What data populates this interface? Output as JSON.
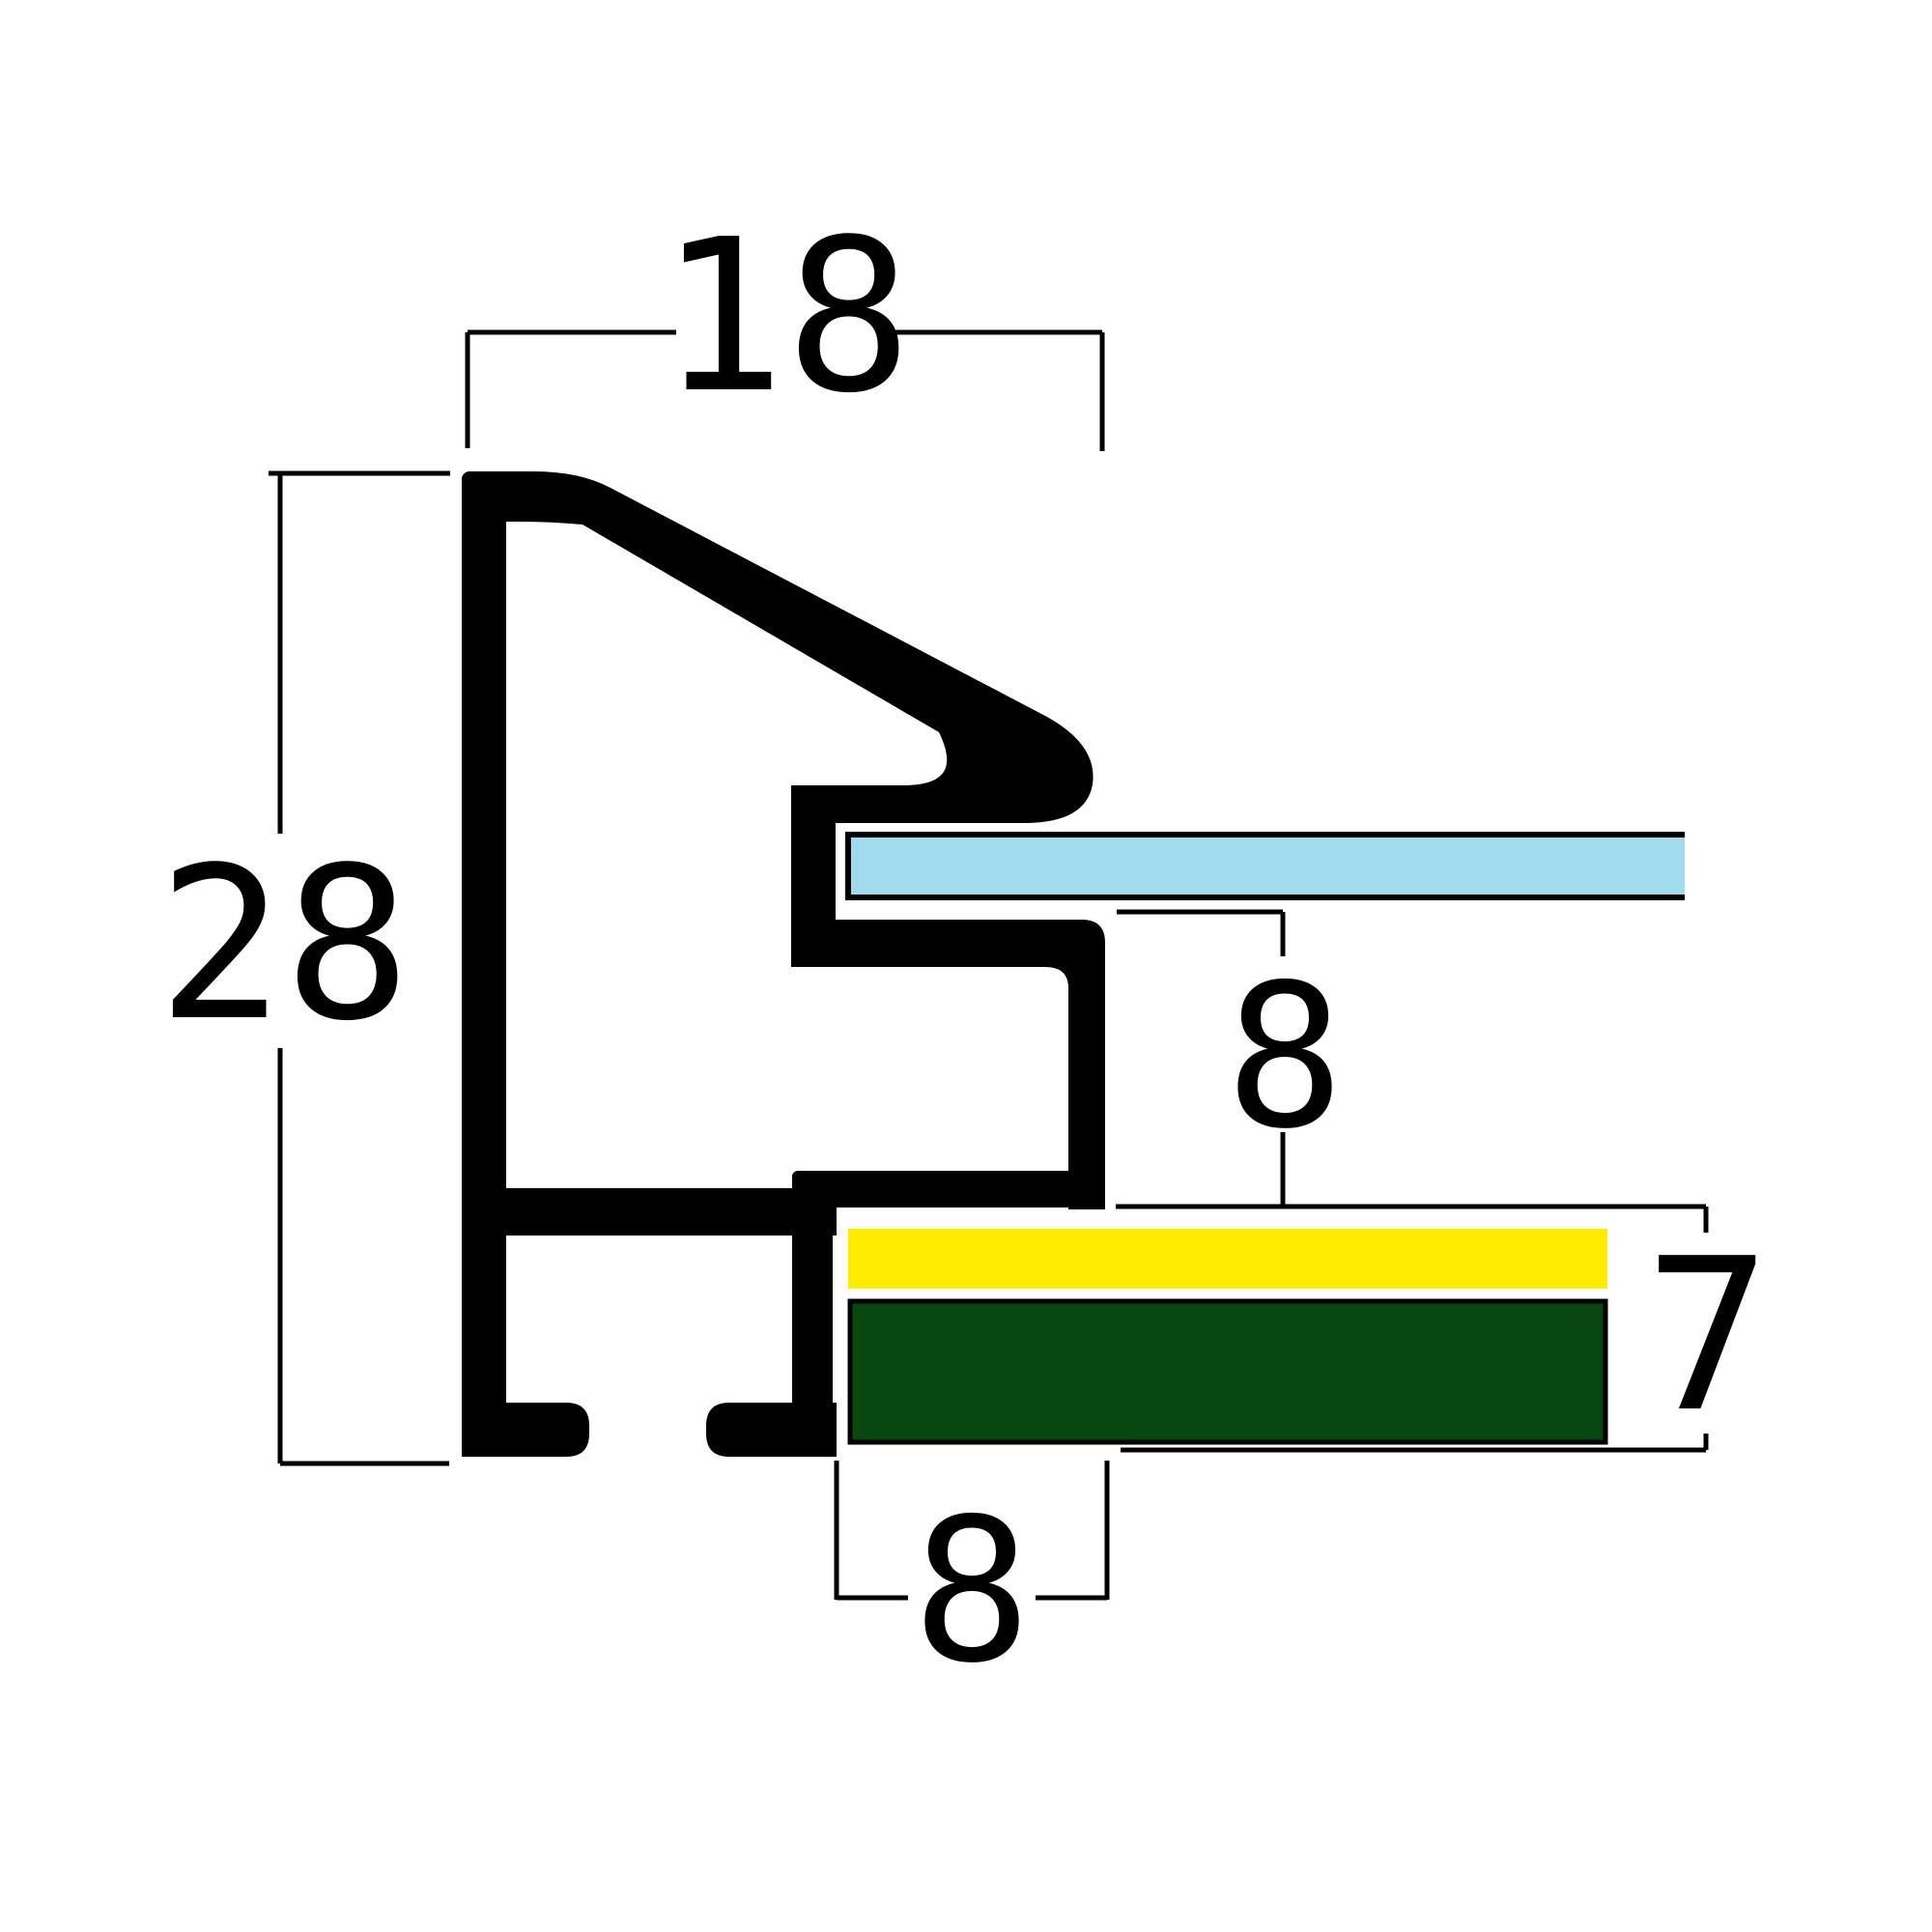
{
  "diagram": {
    "kind": "picture-frame-moulding-cross-section",
    "labels": {
      "top_width": "18",
      "left_height": "28",
      "mid_depth": "8",
      "right_stack": "7",
      "bottom_slot": "8"
    },
    "colors": {
      "profile": "#000000",
      "dim_line": "#000000",
      "glass": "#9FDBEC",
      "mat": "#FFEC00",
      "backing": "#07470F",
      "background": "#FFFFFF"
    }
  }
}
